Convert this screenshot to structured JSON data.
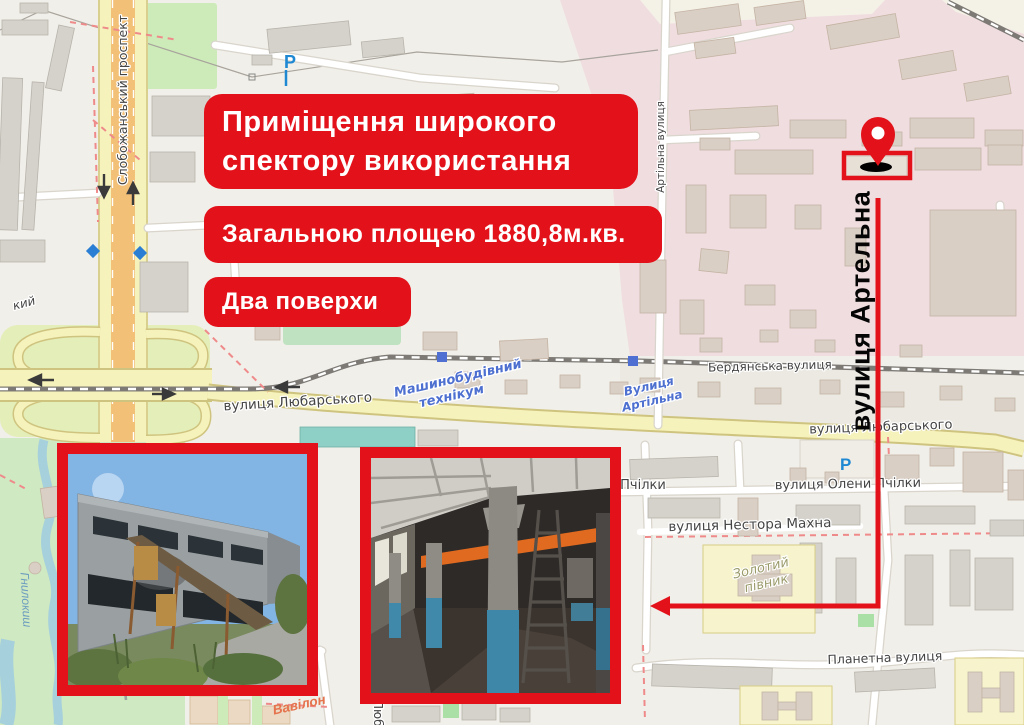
{
  "flyer": {
    "accent_color": "#e3121a",
    "title": {
      "line1": "Приміщення широкого",
      "line2": "спектору використання"
    },
    "area_banner": "Загальною площею 1880,8м.кв.",
    "floors_banner": "Два поверхи",
    "street_callout": "вулиця Артельна"
  },
  "map": {
    "colors": {
      "industrial_zone_pink": "#f0dde0",
      "park_green": "#cfe9c2",
      "road_yellow": "#f6f2bb",
      "water_blue": "#a6d0dc",
      "map_label_blue": "#4d6fd0"
    },
    "labels": {
      "slobozhansky_prospekt": "Слобожанський проспект",
      "artilna_street_road": "Артільна вулиця",
      "lyubarskogo_west": "вулиця Любарського",
      "lyubarskogo_east": "вулиця Любарського",
      "berdyanska": "Бердянська вулиця",
      "tehnikum_line1": "Машинобудівний",
      "tehnikum_line2": "технікум",
      "artilna_stop_line1": "Вулиця",
      "artilna_stop_line2": "Артільна",
      "oleny_pchilky": "вулиця Олени Пчілки",
      "pchilky_fragment": "Пчілки",
      "nestora_makhna": "вулиця Нестора Махна",
      "zolotyi_line1": "Золотий",
      "zolotyi_line2": "півник",
      "planetna": "Планетна вулиця",
      "hnylokysh": "Гнилокиш",
      "vavilon": "Вавілон",
      "suburb_fragment": "кий",
      "lyub_fragment": "Люб",
      "parking_p_north": "P",
      "parking_p_south": "P"
    }
  }
}
